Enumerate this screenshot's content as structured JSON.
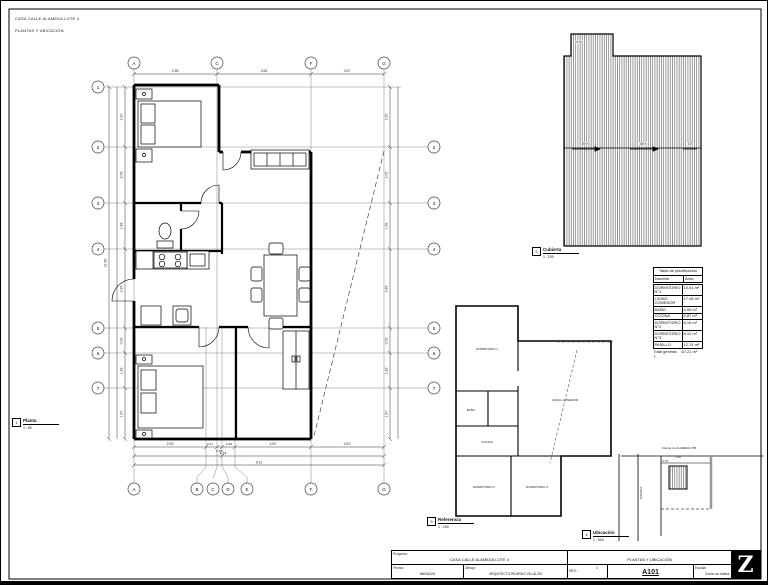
{
  "sheet": {
    "header_line1": "CASA CALLE ALAMEDA LOTE 4",
    "header_line2": "PLANTAS Y UBICACIÓN"
  },
  "grid": {
    "cols_top": [
      "A",
      "C",
      "F",
      "G"
    ],
    "cols_bottom": [
      "A",
      "B",
      "C",
      "D",
      "E",
      "F",
      "G"
    ],
    "rows_left": [
      "1",
      "2",
      "3",
      "4",
      "5",
      "6",
      "7"
    ],
    "rows_right": [
      "2",
      "3",
      "4",
      "5",
      "6",
      "7"
    ]
  },
  "dims": {
    "top": [
      "2.96",
      "3.52",
      "2.67"
    ],
    "bottom_row1": [
      "2.53",
      "0.41",
      "0.18",
      "0.48",
      "2.87",
      "2.67"
    ],
    "bottom_row2": "4.74",
    "bottom_row3": "9.11",
    "left": [
      "2.20",
      "2.05",
      "1.68",
      "2.89",
      "0.92",
      "1.28",
      "1.87"
    ],
    "left_total": "12.89",
    "right": [
      "2.20",
      "2.05",
      "1.68",
      "2.89",
      "0.92",
      "1.28",
      "1.87"
    ]
  },
  "roof": {
    "slope_left": "35%",
    "slope_right": "35%",
    "dim_top": "0.60",
    "dim_right": "1.8"
  },
  "view_tags": {
    "planta": {
      "number": "1",
      "name": "Planta",
      "scale": "1 : 50"
    },
    "cubierta": {
      "number": "2",
      "name": "Cubierta",
      "scale": "1 : 100"
    },
    "referencia": {
      "number": "3",
      "name": "Referencia",
      "scale": "1 : 100"
    },
    "ubicacion": {
      "number": "4",
      "name": "Ubicación",
      "scale": "1 : 500"
    }
  },
  "reference_plan": {
    "labels": [
      "DORMITORIO 1",
      "BAÑO",
      "COCINA",
      "LIVING COMEDOR",
      "DORMITORIO 2",
      "DORMITORIO 3"
    ]
  },
  "site": {
    "street_top": "CALLE LA ALAMEDA 785",
    "street_left": "AVENIDA",
    "dim1": "0.70",
    "dim2": "1.30"
  },
  "schedule": {
    "title": "Tabla de planificación",
    "col_name": "Nombre",
    "col_area": "Área",
    "rows": [
      {
        "name": "DORMITORIO N°1",
        "area": "10.01 m²"
      },
      {
        "name": "LIVING COMEDOR",
        "area": "17.28 m²"
      },
      {
        "name": "BAÑO",
        "area": "4.00 m²"
      },
      {
        "name": "COCINA",
        "area": "6.87 m²"
      },
      {
        "name": "DORMITORIO N°2",
        "area": "8.19 m²"
      },
      {
        "name": "DORMITORIO N°3",
        "area": "8.12 m²"
      },
      {
        "name": "PASILLO",
        "area": "12.74 m²"
      }
    ],
    "total_label": "Total general: 7",
    "total_area": "67.21 m²"
  },
  "titleblock": {
    "project_label": "Proyecto:",
    "project": "CASA CALLE ALAMEDA LOTE 4",
    "sheet_title": "PLANTAS Y UBICACIÓN",
    "date_label": "Fecha:",
    "date": "06/06/24",
    "drawn_label": "Dibujo:",
    "drawn": "ARQUITECTO RICARDO VILLALÓN",
    "rev_label": "REV: -",
    "rev": "1",
    "sheet_number": "A101",
    "scale_label": "Escala:",
    "scale": "Como se indica",
    "logo": "Z"
  }
}
